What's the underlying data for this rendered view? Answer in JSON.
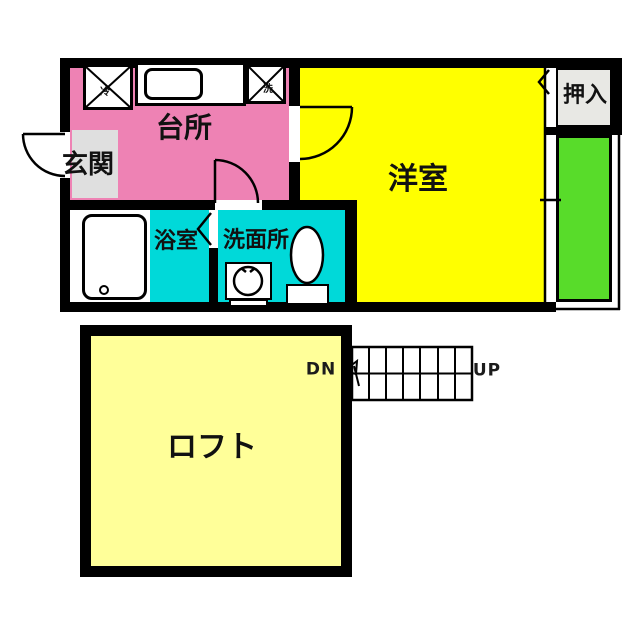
{
  "document": {
    "type": "japanese-apartment-floor-plan",
    "floors": [
      "main-floor",
      "loft-level"
    ]
  },
  "labels": {
    "kitchen": "台所",
    "entrance": "玄関",
    "western_room": "洋室",
    "closet": "押入",
    "bathroom": "浴室",
    "washroom": "洗面所",
    "loft": "ロフト",
    "stairs_down": "DN",
    "stairs_up": "UP",
    "fridge_mark": "冷",
    "washer_mark": "洗"
  },
  "fixtures": [
    "refrigerator-space-x-box",
    "kitchen-sink-counter",
    "washer-space-x-box",
    "bathtub",
    "washbasin",
    "toilet",
    "entry-door-swing",
    "kitchen-door-swing",
    "western-room-door-swing",
    "bathroom-folding-door",
    "closet-folding-door",
    "window-to-balcony",
    "staircase"
  ],
  "stairs": {
    "down_label": "DN",
    "up_label": "UP",
    "treads": 7
  },
  "colors": {
    "wall": "#000000",
    "kitchen": "#EE82B4",
    "western_room": "#FFFF00",
    "wet_area": "#00D9D9",
    "balcony": "#58DC2A",
    "closet": "#E8E8E4",
    "entrance_floor": "#DFDFDF",
    "loft": "#FFFF99",
    "background": "#FFFFFF"
  }
}
